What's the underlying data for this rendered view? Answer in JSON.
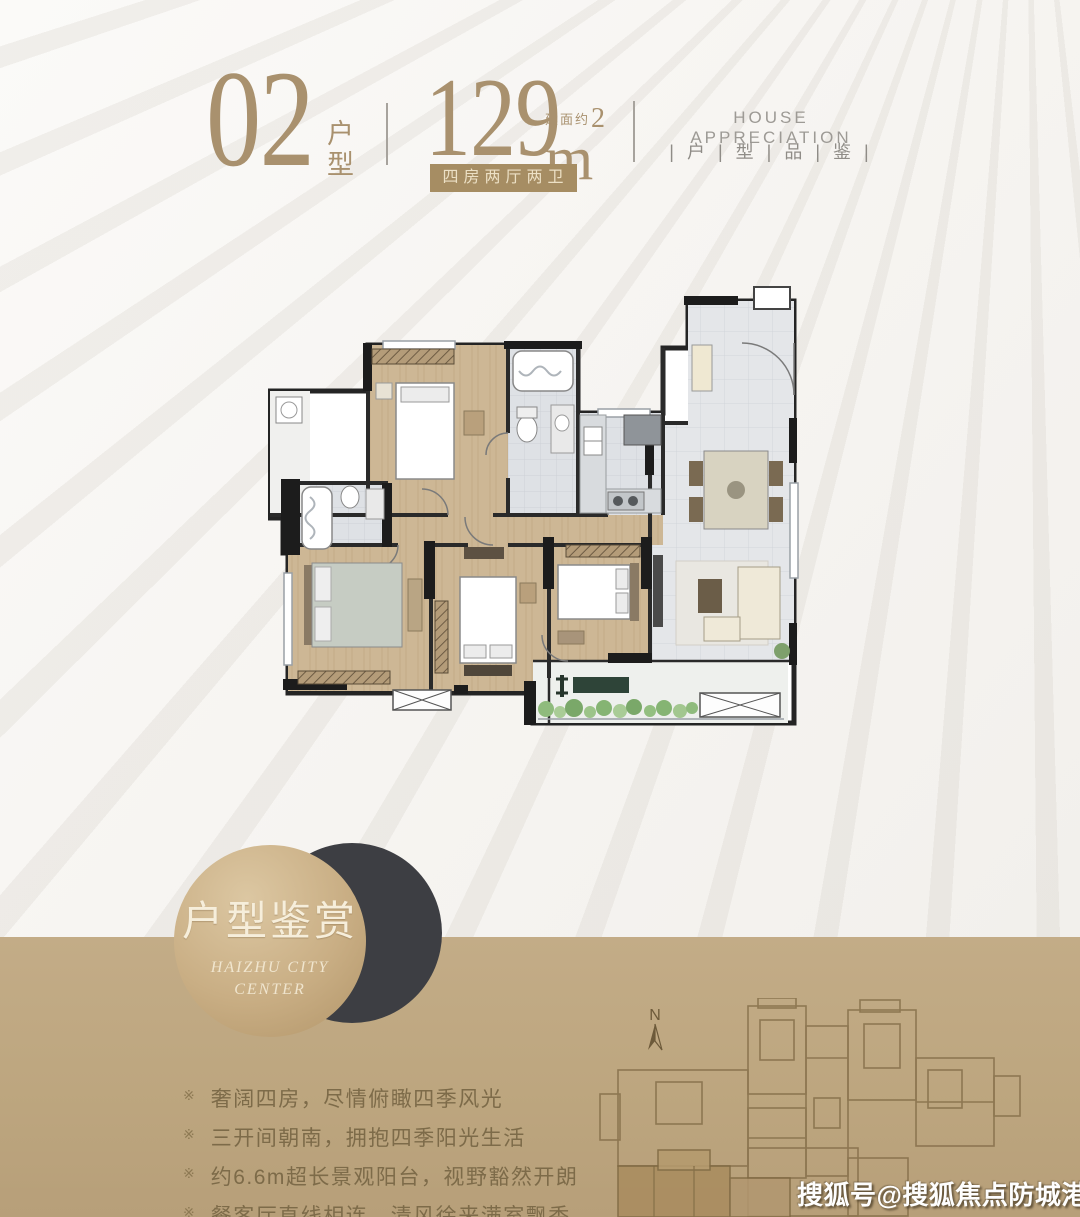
{
  "header": {
    "unit_number": "02",
    "unit_label_top": "户",
    "unit_label_bottom": "型",
    "area_value": "129",
    "area_prefix": "建面约",
    "area_unit": "m",
    "area_sup": "2",
    "badge": "四房两厅两卫",
    "right_title": "HOUSE APPRECIATION",
    "right_subtitle": "| 户 | 型 | 品 | 鉴 |"
  },
  "showcase": {
    "circle_title": "户型鉴赏",
    "circle_subtitle_line1": "HAIZHU CITY",
    "circle_subtitle_line2": "CENTER",
    "bullet_marker": "※",
    "bullets": [
      "奢阔四房，尽情俯瞰四季风光",
      "三开间朝南，拥抱四季阳光生活",
      "约6.6m超长景观阳台，视野豁然开朗",
      "餐客厅直线相连，清风徐来满室飘香"
    ]
  },
  "siteplan": {
    "compass_label": "N"
  },
  "watermark": "搜狐号@搜狐焦点防城港站",
  "colors": {
    "gold": "#a9916e",
    "badge_background": "#a68d63",
    "tan_background": "#bda67f",
    "dark_circle": "#3d3e43",
    "cream_text": "#f6eedb",
    "bullet_text": "#7d6b49"
  }
}
